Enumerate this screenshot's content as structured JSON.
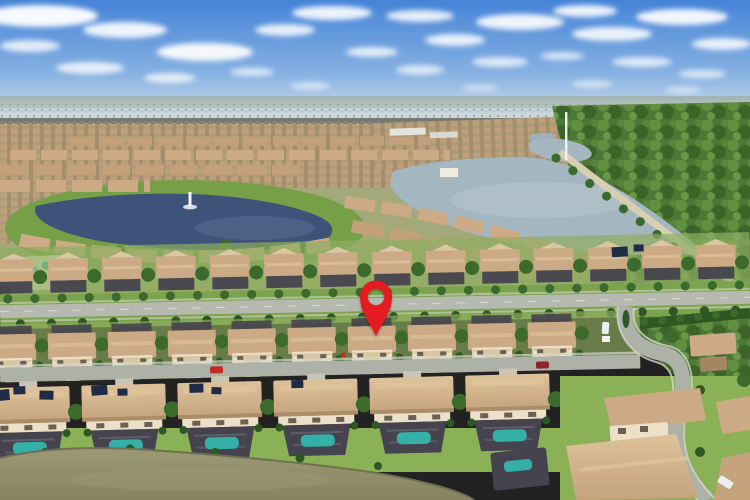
{
  "scene": {
    "title": "Aerial drone photo of a suburban residential community marked with a red map pin",
    "marker": {
      "type": "map-pin",
      "x": 376,
      "head_cy": 297,
      "tip_y": 336,
      "hole": "see-through",
      "color": "#e31b21"
    },
    "landscape": {
      "sky": "blue sky with scattered white clouds",
      "horizon": "hazy distant housing developments",
      "midground": "community with dark lake (fountain), large light lake, tree-lined berm road, conservation forest on right",
      "amenity": "community pool and park at left edge",
      "foreground": "parallel rows of tan-roofed two-story homes, divided main road, residential street, screened pool enclosures, murky pond at bottom",
      "vehicles": [
        "red car",
        "maroon car",
        "white van at entrance",
        "white car on side street"
      ]
    }
  },
  "palette": {
    "sky_top": "#4583d7",
    "sky_mid": "#86b1e2",
    "sky_low": "#cfdeed",
    "cloud": "#ffffff",
    "haze": "#bdc3b6",
    "distant": "#b0a99a",
    "suburb_tan": "#b49a77",
    "suburb_dark": "#8c7d62",
    "lake_left": "#3d5379",
    "lake_right": "#a4b6c0",
    "forest": "#4c7836",
    "forest_dark": "#30551f",
    "forest_light": "#6d9b46",
    "park_green": "#75a047",
    "grass": "#7ca44e",
    "lawn": "#8ab155",
    "road": "#b5b9b0",
    "street": "#aeb1a7",
    "sidewalk": "#d3d5ca",
    "berm_road": "#d8cfb3",
    "roof": "#cbaa85",
    "roof_light": "#e2c8a0",
    "roof_shadow": "#a48762",
    "wall": "#ece1c8",
    "gable": "#d9c6a3",
    "driveway": "#c9c4b4",
    "lanai": "#45434e",
    "pool": "#35b0a8",
    "pool_blue": "#4fc3d9",
    "solar": "#202b46",
    "tree": "#3c6a2c",
    "hedge": "#2f5724",
    "pond": "#8e8d69",
    "pond_edge": "#6e7051",
    "pin": "#e31b21",
    "car_red": "#c22b20",
    "car_maroon": "#8e2430",
    "car_white": "#eceff0"
  }
}
